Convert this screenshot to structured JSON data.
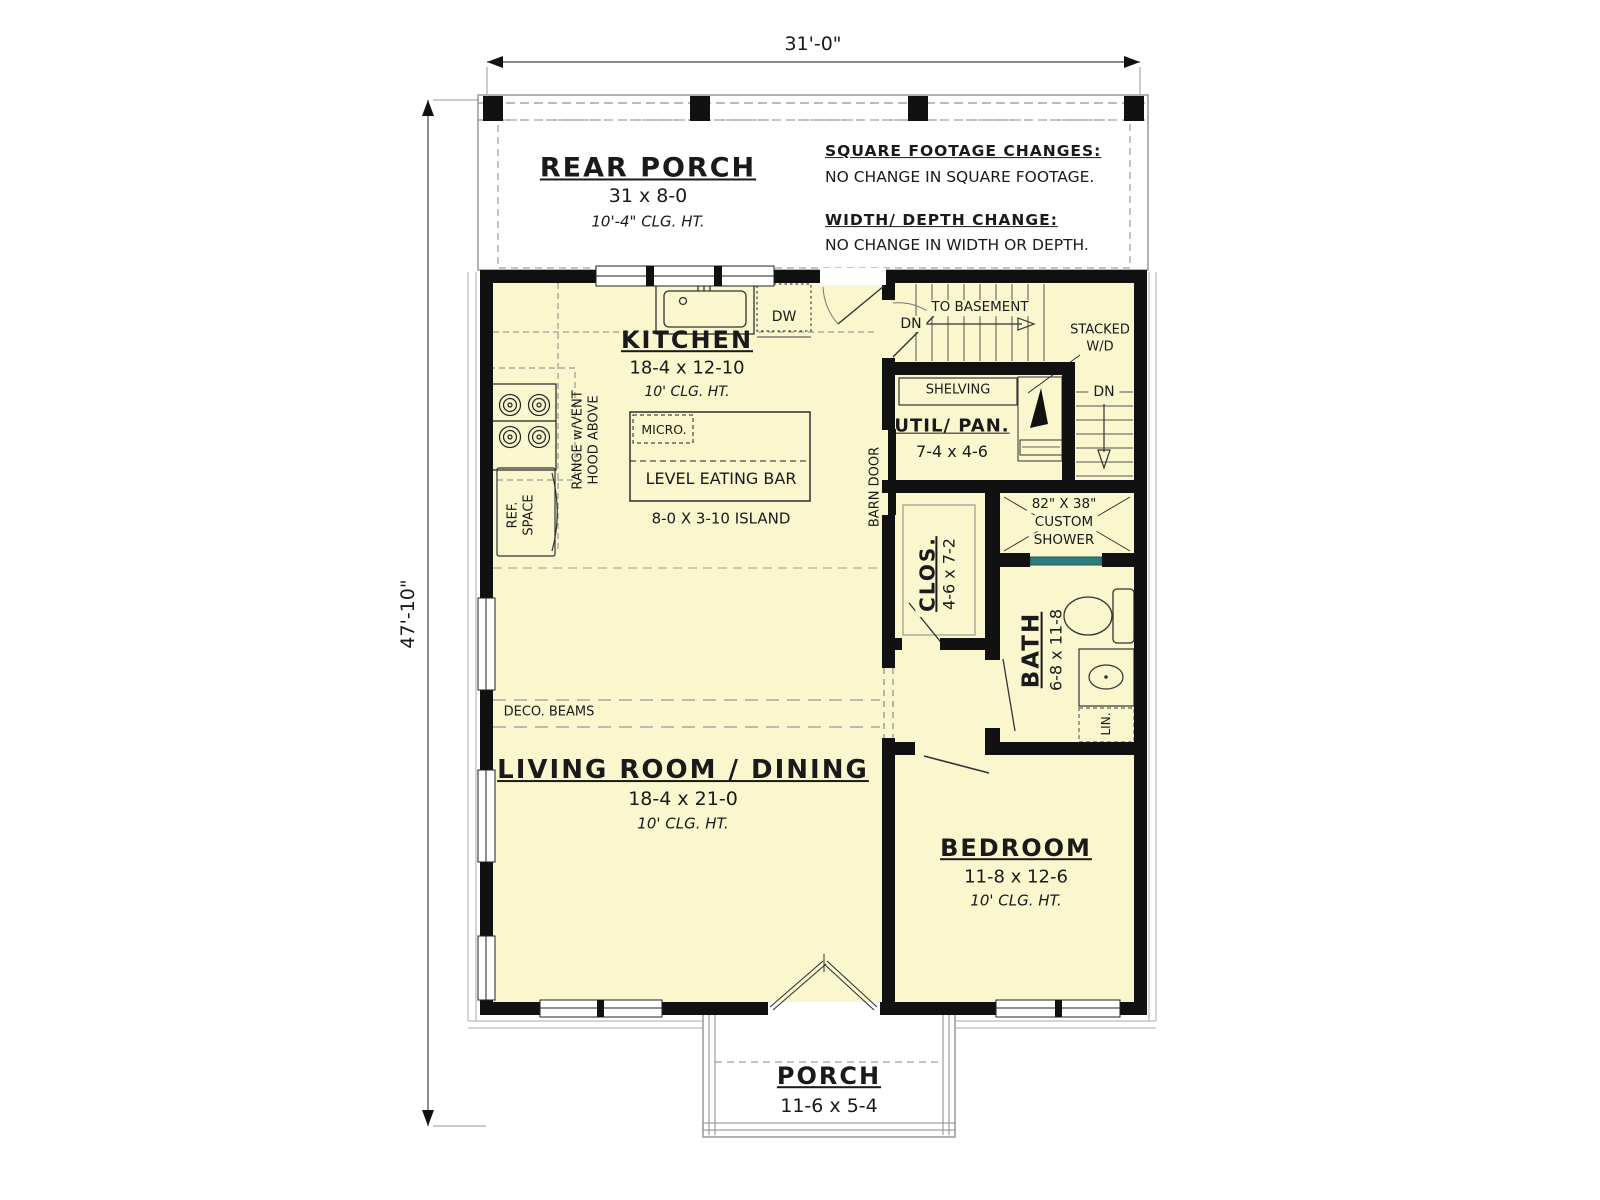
{
  "plan_title": "First Floor Plan",
  "dimensions": {
    "overall_width": "31'-0\"",
    "overall_depth": "47'-10\""
  },
  "rear_porch": {
    "name": "REAR PORCH",
    "size": "31 x 8-0",
    "ceiling": "10'-4\" CLG. HT."
  },
  "notes": {
    "square_footage_title": "SQUARE FOOTAGE CHANGES:",
    "square_footage_body": "NO CHANGE IN SQUARE FOOTAGE.",
    "width_depth_title": "WIDTH/ DEPTH CHANGE:",
    "width_depth_body": "NO CHANGE IN WIDTH OR DEPTH."
  },
  "kitchen": {
    "name": "KITCHEN",
    "size": "18-4 x 12-10",
    "ceiling": "10' CLG. HT.",
    "dishwasher": "DW",
    "microwave": "MICRO.",
    "eating_bar": "LEVEL EATING BAR",
    "island": "8-0 X 3-10 ISLAND",
    "range_line1": "RANGE w/VENT",
    "range_line2": "HOOD ABOVE",
    "ref_line1": "REF.",
    "ref_line2": "SPACE",
    "barn_door": "BARN DOOR"
  },
  "stairs": {
    "to_basement": "TO BASEMENT",
    "down_left": "DN",
    "down_right": "DN",
    "stacked_line1": "STACKED",
    "stacked_line2": "W/D"
  },
  "utility": {
    "shelving": "SHELVING",
    "name": "UTIL/ PAN.",
    "size": "7-4 x 4-6"
  },
  "closet": {
    "name": "CLOS.",
    "size": "4-6 x 7-2"
  },
  "shower": {
    "line1": "82\" X 38\"",
    "line2": "CUSTOM",
    "line3": "SHOWER"
  },
  "bath": {
    "name": "BATH",
    "size": "6-8 x 11-8",
    "linen": "LIN."
  },
  "living": {
    "name": "LIVING ROOM / DINING",
    "size": "18-4 x 21-0",
    "ceiling": "10' CLG. HT.",
    "deco_beams": "DECO. BEAMS"
  },
  "bedroom": {
    "name": "BEDROOM",
    "size": "11-8 x 12-6",
    "ceiling": "10' CLG. HT."
  },
  "porch": {
    "name": "PORCH",
    "size": "11-6 x 5-4"
  },
  "colors": {
    "floor": "#FAF6CD",
    "wall": "#111111",
    "shower_glass": "#2E7D7D",
    "paper": "#FFFFFF"
  }
}
